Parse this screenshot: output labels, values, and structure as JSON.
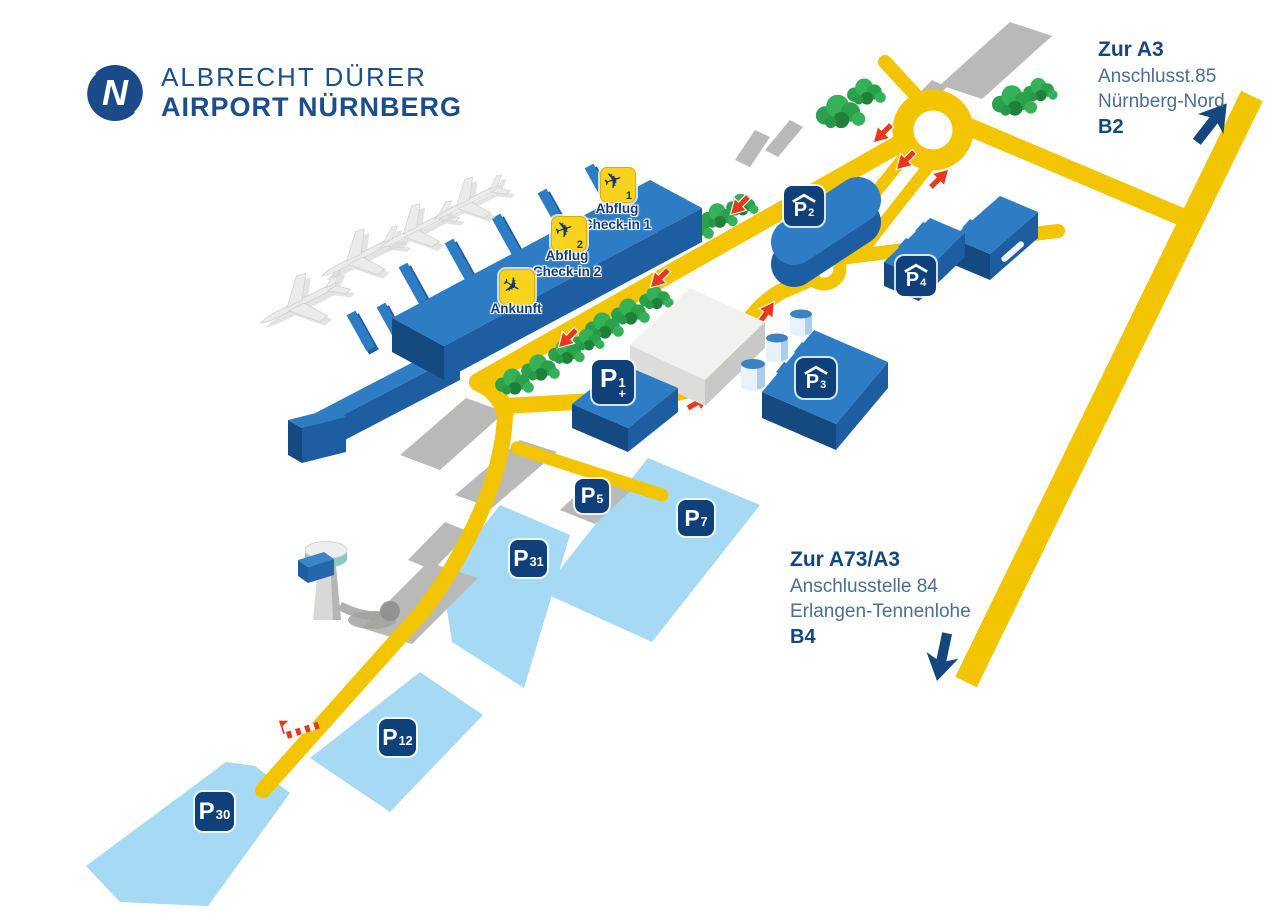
{
  "brand": {
    "name_line1": "ALBRECHT DÜRER",
    "name_line2": "AIRPORT NÜRNBERG",
    "logo_letter": "N"
  },
  "directions": {
    "a3": {
      "title": "Zur A3",
      "subtitle1": "Anschlusst.85",
      "subtitle2": "Nürnberg-Nord",
      "road_label": "B2"
    },
    "a73": {
      "title": "Zur A73/A3",
      "subtitle1": "Anschlusstelle 84",
      "subtitle2": "Erlangen-Tennenlohe",
      "road_label": "B4"
    }
  },
  "terminal": {
    "checkin1": {
      "number": "1",
      "label_line1": "Abflug",
      "label_line2": "Check-in 1"
    },
    "checkin2": {
      "number": "2",
      "label_line1": "Abflug",
      "label_line2": "Check-in 2"
    },
    "arrival": {
      "label": "Ankunft"
    }
  },
  "parking": {
    "p1": {
      "letter": "P",
      "number": "1",
      "suffix": "+",
      "covered": false
    },
    "p2": {
      "letter": "P",
      "number": "2",
      "covered": true
    },
    "p3": {
      "letter": "P",
      "number": "3",
      "covered": true
    },
    "p4": {
      "letter": "P",
      "number": "4",
      "covered": true
    },
    "p5": {
      "letter": "P",
      "number": "5",
      "covered": false
    },
    "p7": {
      "letter": "P",
      "number": "7",
      "covered": false
    },
    "p12": {
      "letter": "P",
      "number": "12",
      "covered": false
    },
    "p30": {
      "letter": "P",
      "number": "30",
      "covered": false
    },
    "p31": {
      "letter": "P",
      "number": "31",
      "covered": false
    }
  },
  "colors": {
    "navy": "#14477e",
    "sign_navy": "#10407a",
    "road_yellow": "#f2c500",
    "terminal_blue": "#2e7cc3",
    "terminal_blue_dark": "#1d5ea2",
    "lot_light_blue": "#a6d9f4",
    "tree_green": "#2fa84e",
    "arrow_red": "#e6391d",
    "checkin_yellow": "#f8d21c"
  }
}
